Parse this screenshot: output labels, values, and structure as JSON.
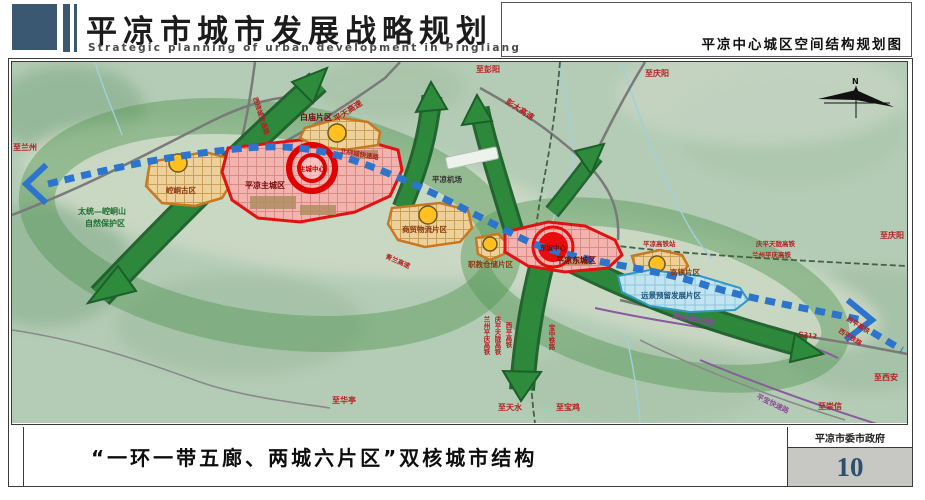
{
  "header": {
    "title": "平凉市城市发展战略规划",
    "subtitle": "Strategic planning of urban development in Pingliang",
    "map_title": "平凉中心城区空间结构规划图"
  },
  "footer": {
    "caption": "“一环一带五廊、两城六片区”双核城市结构",
    "agency": "平凉市委市政府",
    "page_number": "10"
  },
  "map": {
    "compass": "N",
    "zones": {
      "kongtong": {
        "label": "崆峒古区"
      },
      "main_city": {
        "label": "平凉主城区",
        "core": "主城中心"
      },
      "baimiao": {
        "label": "白庙片区"
      },
      "trade": {
        "label": "商贸物流片区"
      },
      "vocational": {
        "label": "职教仓储片区"
      },
      "east_city": {
        "label": "平凉东城区",
        "core": "东城中心"
      },
      "hsr": {
        "label": "高铁片区",
        "station": "平凉高铁站"
      },
      "reserve": {
        "label": "远景预留发展片区"
      }
    },
    "roads": {
      "pingtian": "平天高速",
      "pengda": "彭大高速",
      "north_ring": "北绕城快速路",
      "west_ring": "西绕城快速路",
      "south_ring": "南绕城快速路",
      "qinglan": "青兰高速",
      "g312": "G312",
      "pingbao": "平宝快速路",
      "xiping_hsr": "西平高铁",
      "xiping_rail": "西平铁路",
      "qptl": "庆平天陇高铁",
      "lzpq": "兰州平庆高铁",
      "baozhong": "宝中铁路"
    },
    "destinations": {
      "lanzhou": "至兰州",
      "pengyang": "至彭阳",
      "qingyang_top": "至庆阳",
      "qingyang_right": "至庆阳",
      "xian": "至西安",
      "chongxin": "至崇信",
      "huating": "至华亭",
      "tianshui": "至天水",
      "baoji": "至宝鸡"
    },
    "features": {
      "airport": "平凉机场",
      "nature_reserve_line1": "太统—崆峒山",
      "nature_reserve_line2": "自然保护区"
    }
  },
  "colors": {
    "header_accent": "#3a5872",
    "corridor_green": "#2e8b3c",
    "transit_blue": "#2d74cc",
    "zone_red": "#e31212",
    "zone_orange": "#c87820",
    "reserve_blue": "#2e9ac4",
    "node_yellow": "#ffc020",
    "page_number_blue": "#2d4e6e"
  }
}
